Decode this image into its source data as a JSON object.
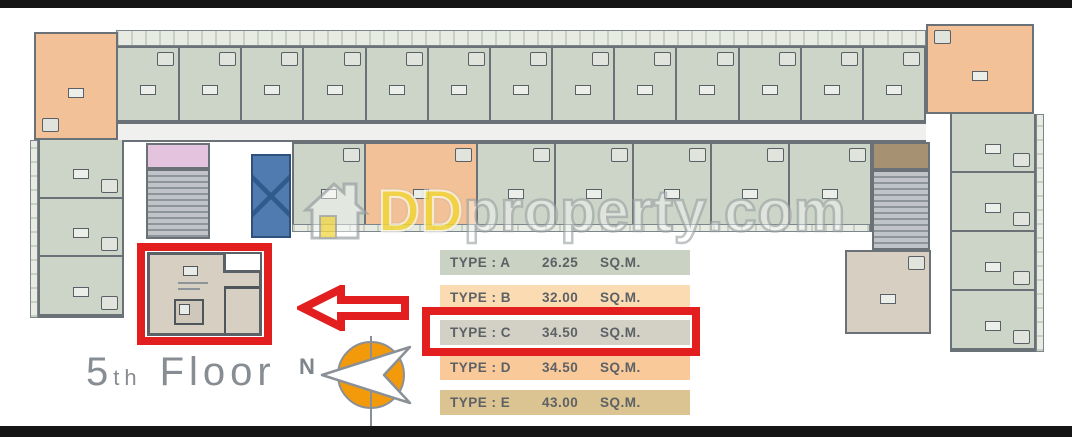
{
  "floor": {
    "number": "5",
    "suffix": "th",
    "word": "Floor"
  },
  "compass": {
    "north_label": "N"
  },
  "watermark": {
    "prefix": "DD",
    "middle": "property",
    "suffix": ".com"
  },
  "legend": {
    "rows": [
      {
        "type_label": "TYPE : A",
        "area": "26.25",
        "unit": "SQ.M.",
        "bg": "#c9d2c3",
        "highlighted": false
      },
      {
        "type_label": "TYPE : B",
        "area": "32.00",
        "unit": "SQ.M.",
        "bg": "#fbdcb2",
        "highlighted": false
      },
      {
        "type_label": "TYPE : C",
        "area": "34.50",
        "unit": "SQ.M.",
        "bg": "#d3d1c6",
        "highlighted": true
      },
      {
        "type_label": "TYPE : D",
        "area": "34.50",
        "unit": "SQ.M.",
        "bg": "#f9c99a",
        "highlighted": false
      },
      {
        "type_label": "TYPE : E",
        "area": "43.00",
        "unit": "SQ.M.",
        "bg": "#dcc492",
        "highlighted": false
      }
    ]
  },
  "plan": {
    "top_row": {
      "unit_count": 13
    },
    "second_row": {
      "cells": [
        {
          "w": 72,
          "color": "green"
        },
        {
          "w": 112,
          "color": "orange"
        },
        {
          "w": 78,
          "color": "green"
        },
        {
          "w": 78,
          "color": "green"
        },
        {
          "w": 78,
          "color": "green"
        },
        {
          "w": 78,
          "color": "green"
        },
        {
          "w": 82,
          "color": "green"
        }
      ]
    },
    "left_wing": {
      "unit_count": 3
    },
    "right_wing": {
      "unit_count": 4
    }
  },
  "colors": {
    "red": "#e31e1e",
    "wall": "#6a7277",
    "unit_green": "#ccd5c8",
    "unit_orange": "#f2c197",
    "unit_tan": "#d6cfc2",
    "pink": "#e3c3dd",
    "lift_blue": "#4f7bb0",
    "stair_brown": "#a79173",
    "compass_orange": "#f39a0a",
    "watermark_yellow": "#f1d43b",
    "gray_text": "#878d92"
  }
}
